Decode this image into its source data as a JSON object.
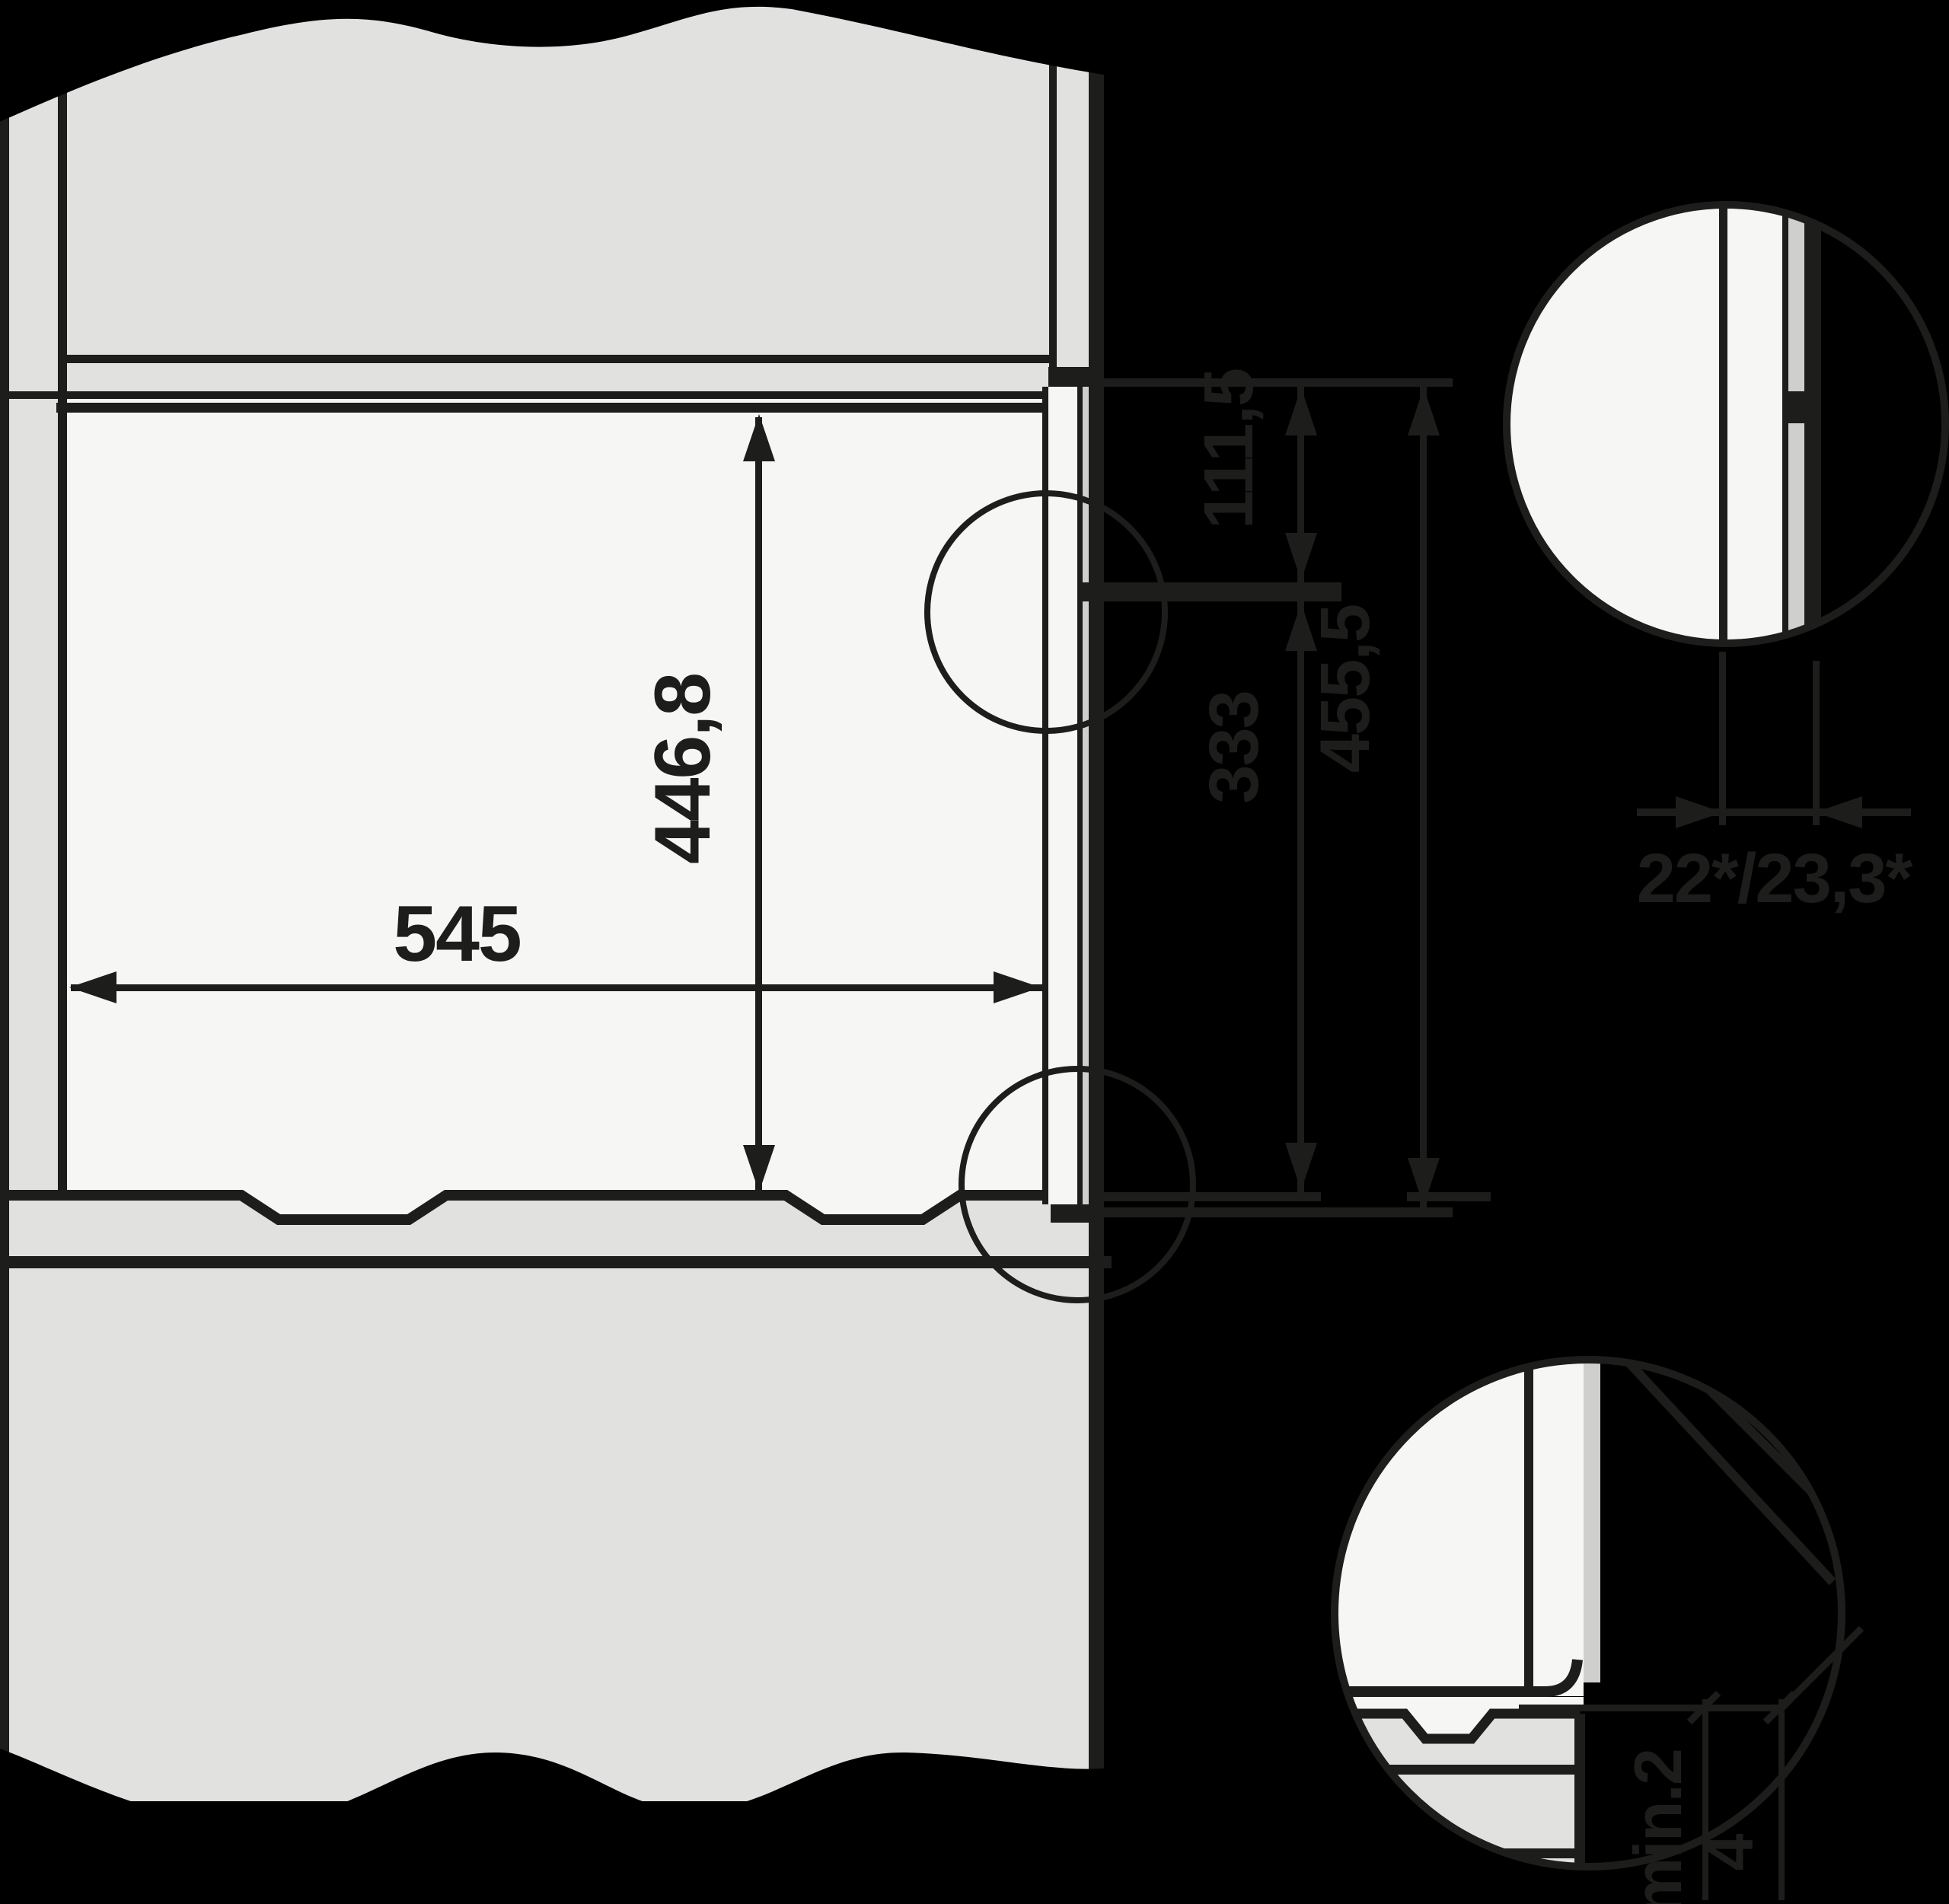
{
  "diagram": {
    "type": "appliance-built-in-niche-cross-section",
    "units": "mm",
    "colors": {
      "background": "#000000",
      "cabinet_gray": "#e1e1e0",
      "niche_white": "#f6f6f4",
      "seal_gray": "#cfcfcd",
      "line": "#1d1d1b"
    },
    "dimensions": {
      "niche_height": "446,8",
      "niche_depth": "545",
      "top_offset": "111,5",
      "middle_offset": "333",
      "front_height": "455,5",
      "door_protrusion": "22*/23,3*",
      "bottom_clearance": "min.2",
      "seal_offset": "4"
    }
  }
}
